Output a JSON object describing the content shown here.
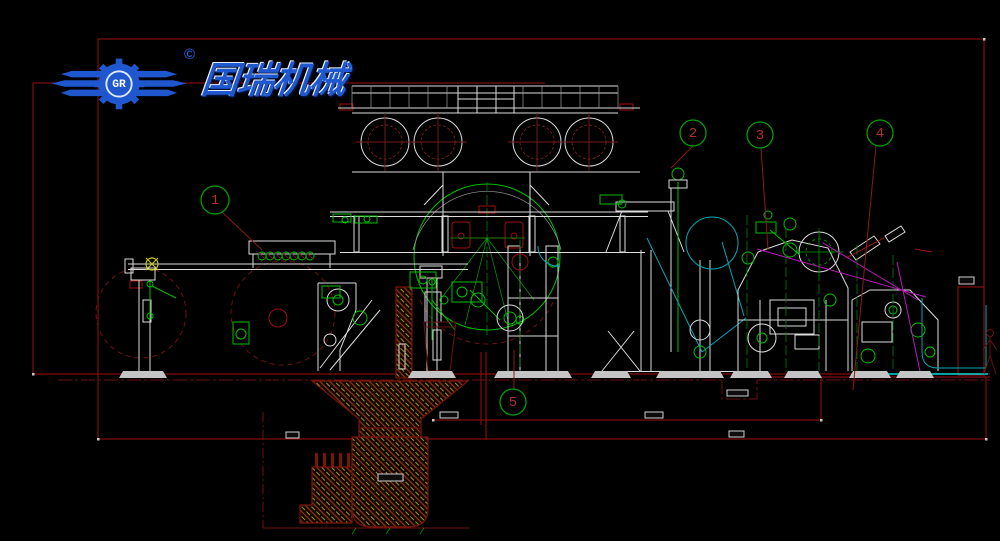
{
  "logo": {
    "company_name_cn": "国瑞机械",
    "monogram": "GR",
    "copyright_mark": "©",
    "brand_color": "#1f57cf"
  },
  "balloons": [
    {
      "label": "1"
    },
    {
      "label": "2"
    },
    {
      "label": "3"
    },
    {
      "label": "4"
    },
    {
      "label": "5"
    }
  ],
  "palette": {
    "background": "#000000",
    "structure": "#dcdcdc",
    "machinery_green": "#00bf00",
    "dimension_red": "#9e0e0e",
    "reference_dark_red": "#6b1212",
    "felt_cyan": "#00a8b8",
    "wire_magenta": "#b818b8",
    "hatch_olive": "#9a9a20",
    "balloon_green": "#00a000",
    "balloon_number_red": "#b03030"
  }
}
